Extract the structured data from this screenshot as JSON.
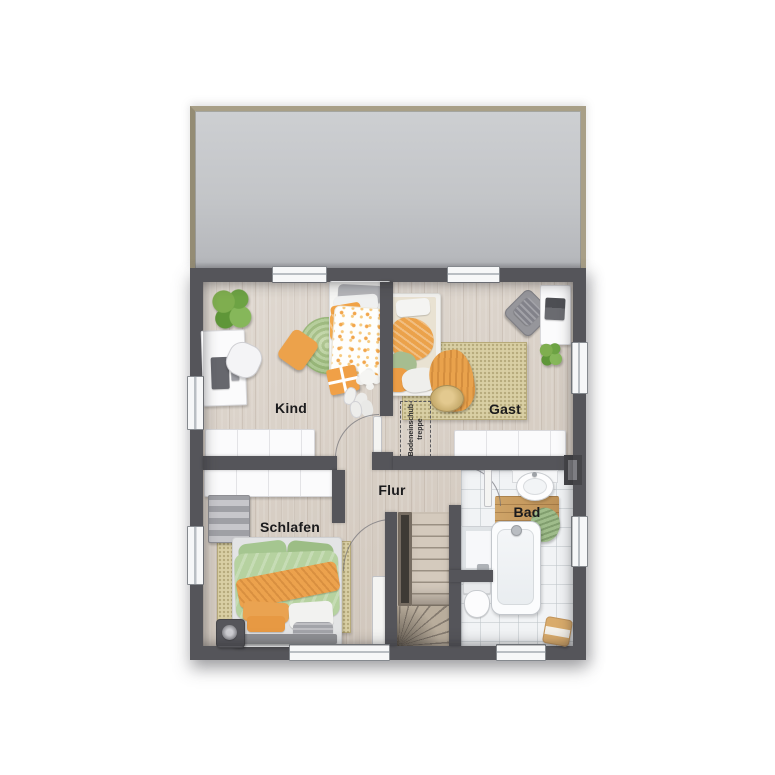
{
  "labels": {
    "kind": "Kind",
    "gast": "Gast",
    "flur": "Flur",
    "schlafen": "Schlafen",
    "bad": "Bad",
    "attic_line1": "Bodeneinschub-",
    "attic_line2": "treppe"
  },
  "colors": {
    "wall": "#55555a",
    "wood_floor": "#d8cfc5",
    "tile_floor": "#f1f3f5",
    "roof_fill": "#c4c6c9",
    "roof_frame": "#a89f87",
    "rug_beige": "#d9cfa4",
    "rug_round_green": "#9dbd7e",
    "accent_orange": "#eca24d",
    "accent_green": "#b6d2a0",
    "window": "#f6f7f8"
  },
  "icons": [
    "window-icon",
    "door-arc-icon",
    "stairs-icon",
    "attic-hatch-icon",
    "bed-icon",
    "desk-icon",
    "chair-icon",
    "plant-icon",
    "rug-icon",
    "wardrobe-icon",
    "sideboard-icon",
    "dresser-icon",
    "speaker-icon",
    "bathtub-icon",
    "shower-icon",
    "sink-icon",
    "toilet-icon",
    "bath-mat-icon",
    "towel-icon",
    "stool-icon",
    "chimney-icon"
  ]
}
